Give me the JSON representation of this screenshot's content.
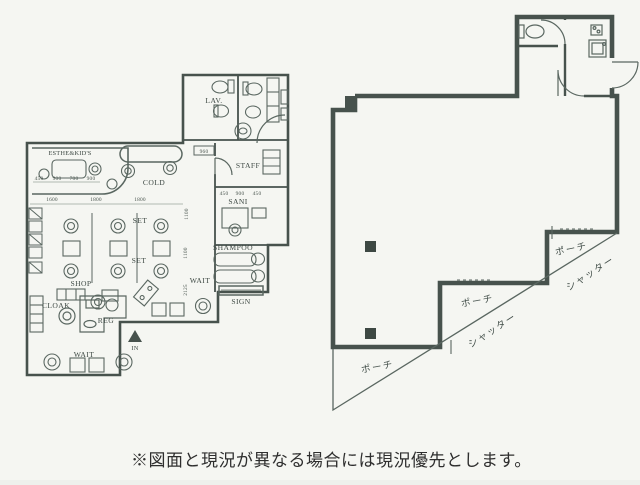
{
  "caption": {
    "text": "※図面と現況が異なる場合には現況優先とします。"
  },
  "left_plan": {
    "labels": {
      "esthe_kids": "ESTHE&KID'S",
      "lav": "LAV.",
      "cold": "COLD",
      "staff": "STAFF",
      "sani": "SANI",
      "shampoo": "SHAMPOO",
      "set_upper": "SET",
      "set_lower": "SET",
      "wait_right": "WAIT",
      "sign": "SIGN",
      "shop": "SHOP",
      "cloak": "CLOAK",
      "reg": "REG",
      "wait_lower": "WAIT",
      "entrance": "IN"
    },
    "dims": {
      "esthe_row": [
        "450",
        "900",
        "700",
        "900"
      ],
      "bays": [
        "1600",
        "1800",
        "1800"
      ],
      "staff_width": "960",
      "sani_row": [
        "450",
        "900",
        "450"
      ],
      "vertical": [
        "1100",
        "1100",
        "2125"
      ]
    }
  },
  "right_plan": {
    "labels": {
      "porch": [
        "ポーチ",
        "ポーチ",
        "ポーチ"
      ],
      "shutter": [
        "シャッター",
        "シャッター"
      ]
    }
  },
  "colors": {
    "wall": "#47524d",
    "line": "#5a6761",
    "paper": "#f5f6f2",
    "caption_ink": "#2e2e2e"
  }
}
